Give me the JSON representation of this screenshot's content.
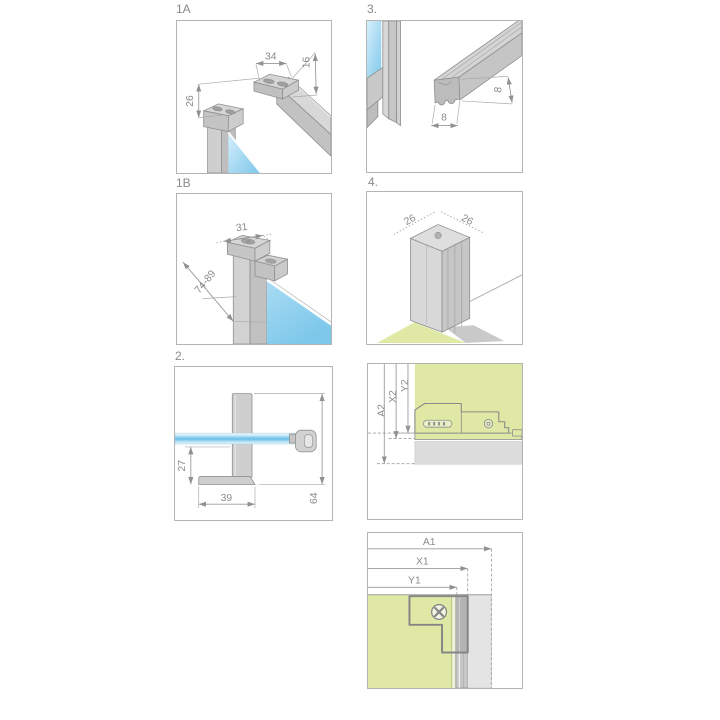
{
  "document": {
    "type": "installation-diagram",
    "background": "#ffffff"
  },
  "colors": {
    "glass_blue": "#74c4e9",
    "wall_green": "#dfe9a5",
    "metal_gray": "#cdcdcd",
    "surface_gray": "#dcdcdc",
    "line_gray": "#8f8f8f",
    "label_gray": "#8a8a8a"
  },
  "panels": [
    {
      "label": "1A",
      "subject": "support-bar-wall-bracket-isometric",
      "dims": {
        "bar_width": "34",
        "bar_depth": "16",
        "wall_offset": "26"
      }
    },
    {
      "label": "3.",
      "subject": "magnetic-seal-profile-section",
      "dims": {
        "profile_width": "8",
        "profile_height": "8"
      }
    },
    {
      "label": "1B",
      "subject": "glass-clamp-profile-isometric",
      "dims": {
        "clamp_width": "31",
        "adjust_range": "74-89"
      }
    },
    {
      "label": "4.",
      "subject": "corner-profile-isometric",
      "dims": {
        "side_a": "26",
        "side_b": "26"
      }
    },
    {
      "label": "2.",
      "subject": "support-bracket-side-view",
      "dims": {
        "foot_offset": "27",
        "foot_length": "39",
        "bracket_height": "64"
      }
    },
    {
      "label": "",
      "subject": "wall-profile-top-measurements",
      "dims": {
        "a": "A2",
        "x": "X2",
        "y": "Y2"
      }
    },
    {
      "label": "",
      "subject": "wall-profile-plan-measurements",
      "dims": {
        "a": "A1",
        "x": "X1",
        "y": "Y1"
      }
    }
  ]
}
